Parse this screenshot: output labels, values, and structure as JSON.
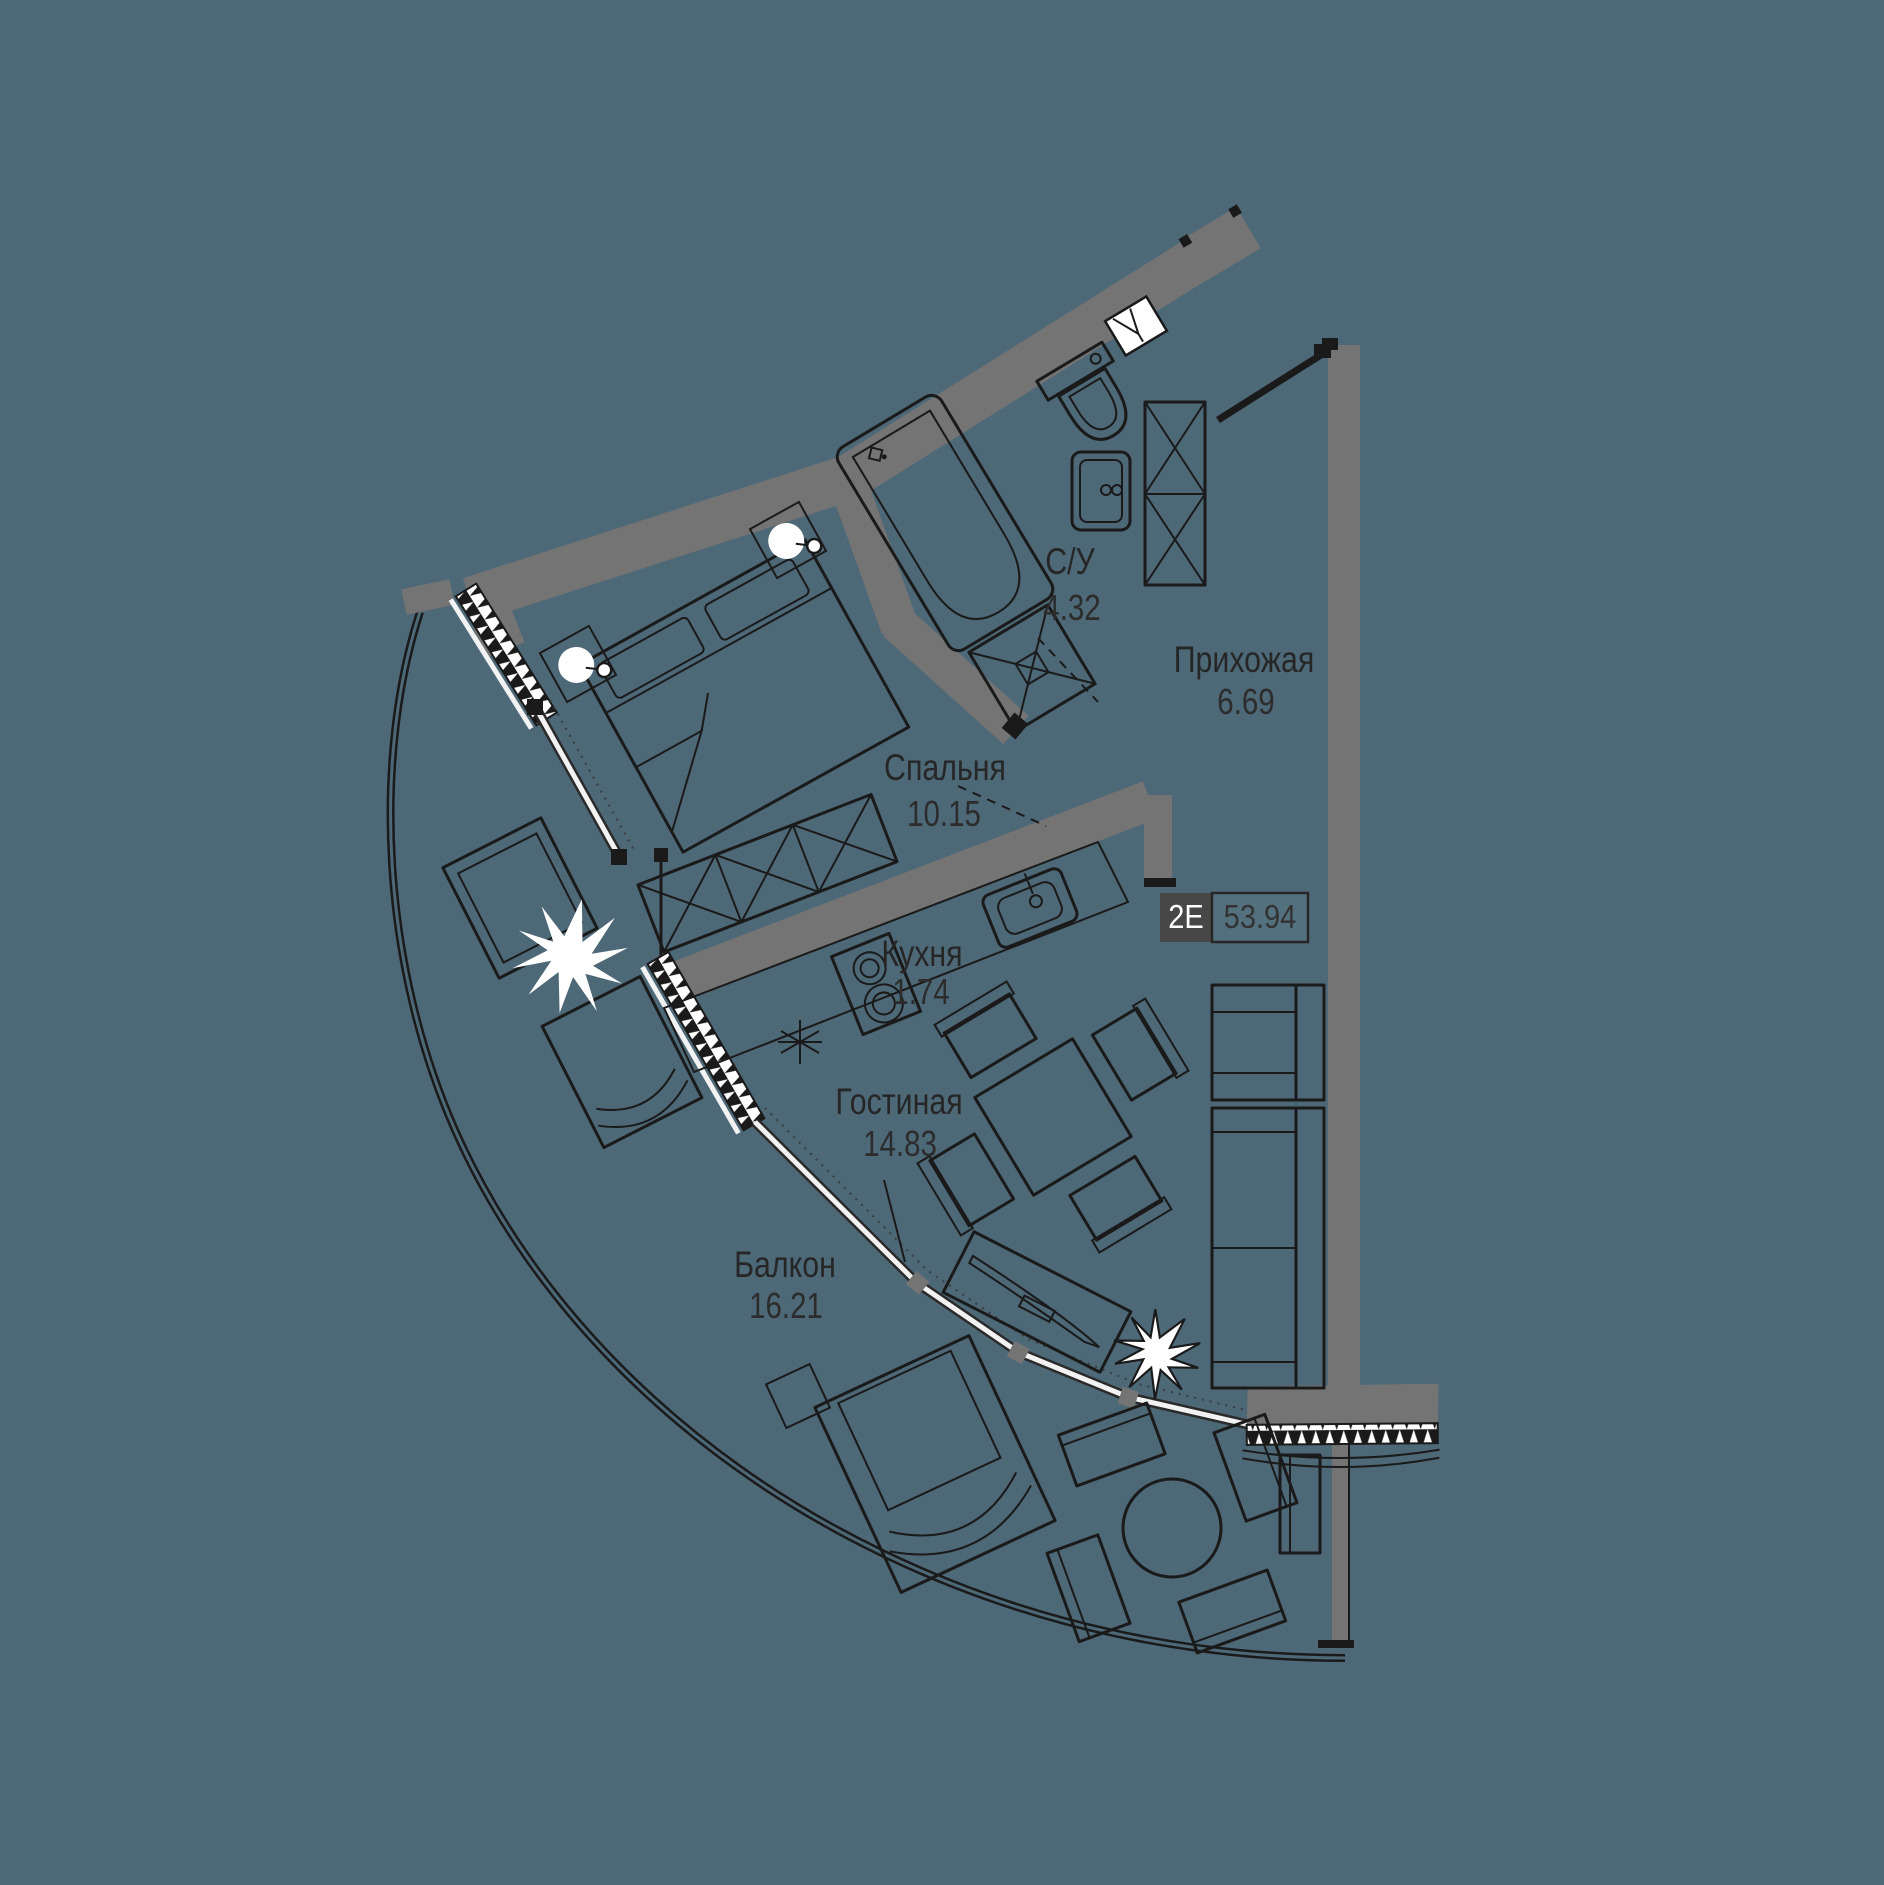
{
  "plan": {
    "title": "apartment-floor-plan",
    "badge": {
      "type_label": "2Е",
      "total_area": "53.94"
    },
    "rooms": [
      {
        "id": "bathroom",
        "label": "С/У",
        "area": "4.32"
      },
      {
        "id": "hallway",
        "label": "Прихожая",
        "area": "6.69"
      },
      {
        "id": "bedroom",
        "label": "Спальня",
        "area": "10.15"
      },
      {
        "id": "kitchen",
        "label": "Кухня",
        "area": "1.74"
      },
      {
        "id": "living",
        "label": "Гостиная",
        "area": "14.83"
      },
      {
        "id": "balcony",
        "label": "Балкон",
        "area": "16.21"
      }
    ],
    "icons": [
      "bed-icon",
      "wardrobe-icon",
      "bathtub-icon",
      "toilet-icon",
      "sink-vanity-icon",
      "shower-icon",
      "kitchen-stove-icon",
      "kitchen-sink-icon",
      "dining-table-icon",
      "sofa-icon",
      "armchair-icon",
      "tv-console-icon",
      "plant-icon",
      "lounge-chair-icon",
      "round-table-icon",
      "door-leaf-icon",
      "window-icon"
    ],
    "colors": {
      "background": "#4d6877",
      "wall": "#747474",
      "line": "#1a1a1a",
      "window": "#f2f2f2",
      "badge_dark": "#474747",
      "text": "#262626",
      "white": "#ffffff"
    }
  }
}
